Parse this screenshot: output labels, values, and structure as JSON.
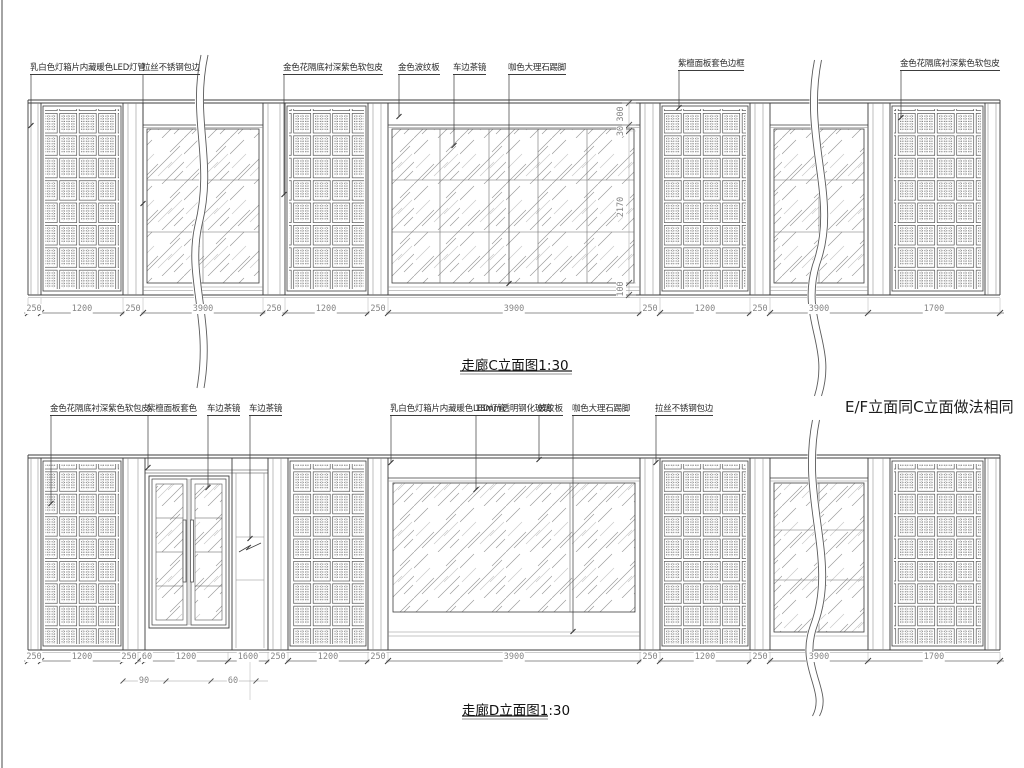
{
  "sheet": {
    "background": "#ffffff",
    "ink": "#3c3c3c",
    "dim_ink": "#8a8a8a"
  },
  "elevation_c": {
    "title": "走廊C立面图1:30",
    "callouts": [
      "乳白色灯箱片内藏暖色LED灯管",
      "拉丝不锈钢包边",
      "金色花隔底衬深紫色软包皮",
      "金色波纹板",
      "车边茶镜",
      "咖色大理石踢脚",
      "紫檀面板套色边框",
      "金色花隔底衬深紫色软包皮"
    ],
    "dims_bottom": [
      "250",
      "1200",
      "250",
      "3900",
      "250",
      "1200",
      "250",
      "3900",
      "250",
      "1200",
      "250",
      "3900",
      "1700"
    ],
    "dims_right": [
      "300",
      "30",
      "2170",
      "100"
    ]
  },
  "elevation_d": {
    "title": "走廊D立面图1:30",
    "note": "E/F立面同C立面做法相同",
    "callouts": [
      "金色花隔底衬深紫色软包皮",
      "紫檀面板套色",
      "车边茶镜",
      "车边茶镜",
      "乳白色灯箱片内藏暖色LED灯管",
      "18mm透明钢化玻璃",
      "波纹板",
      "咖色大理石踢脚",
      "拉丝不锈钢包边"
    ],
    "dims_bottom": [
      "250",
      "1200",
      "250",
      "60",
      "1200",
      "1600",
      "250",
      "1200",
      "250",
      "3900",
      "250",
      "1200",
      "250",
      "3900",
      "1700"
    ],
    "dims_sub": [
      "90",
      "60"
    ]
  }
}
